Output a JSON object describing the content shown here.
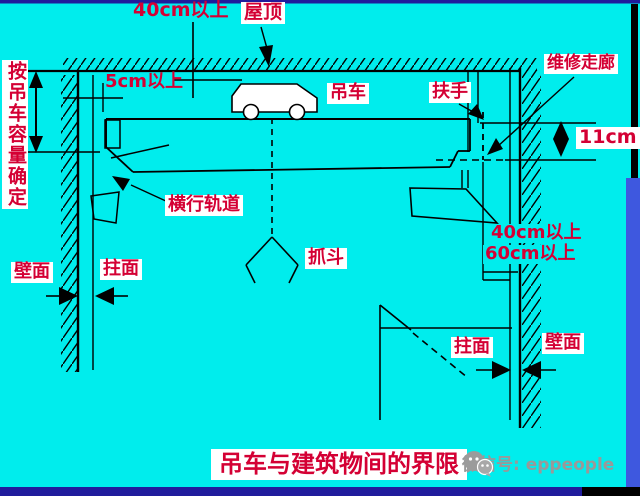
{
  "title": "吊车与建筑物间的界限",
  "watermark": {
    "text": "微信号: eppeople"
  },
  "labels": {
    "top_clearance": "40cm以上",
    "roof": "屋顶",
    "capacity_note": "按吊车容量确定",
    "side_clearance_5cm": "5cm以上",
    "crane": "吊车",
    "handrail": "扶手",
    "maintenance_corridor": "维修走廊",
    "gap_11cm": "11cm",
    "traverse_track": "横行轨道",
    "grab_bucket": "抓斗",
    "clearance_40cm": "40cm以上",
    "clearance_60cm": "60cm以上",
    "wall_left": "壁面",
    "column_left": "拄面",
    "column_right": "拄面",
    "wall_right": "壁面"
  },
  "colors": {
    "background": "#00EDED",
    "label_red": "#D40034",
    "line_black": "#000000",
    "edge_bar_navy": "#201C9C",
    "edge_bar_blue": "#3E58DF",
    "label_background": "#FFFFFF",
    "watermark_gray": "#999999"
  }
}
